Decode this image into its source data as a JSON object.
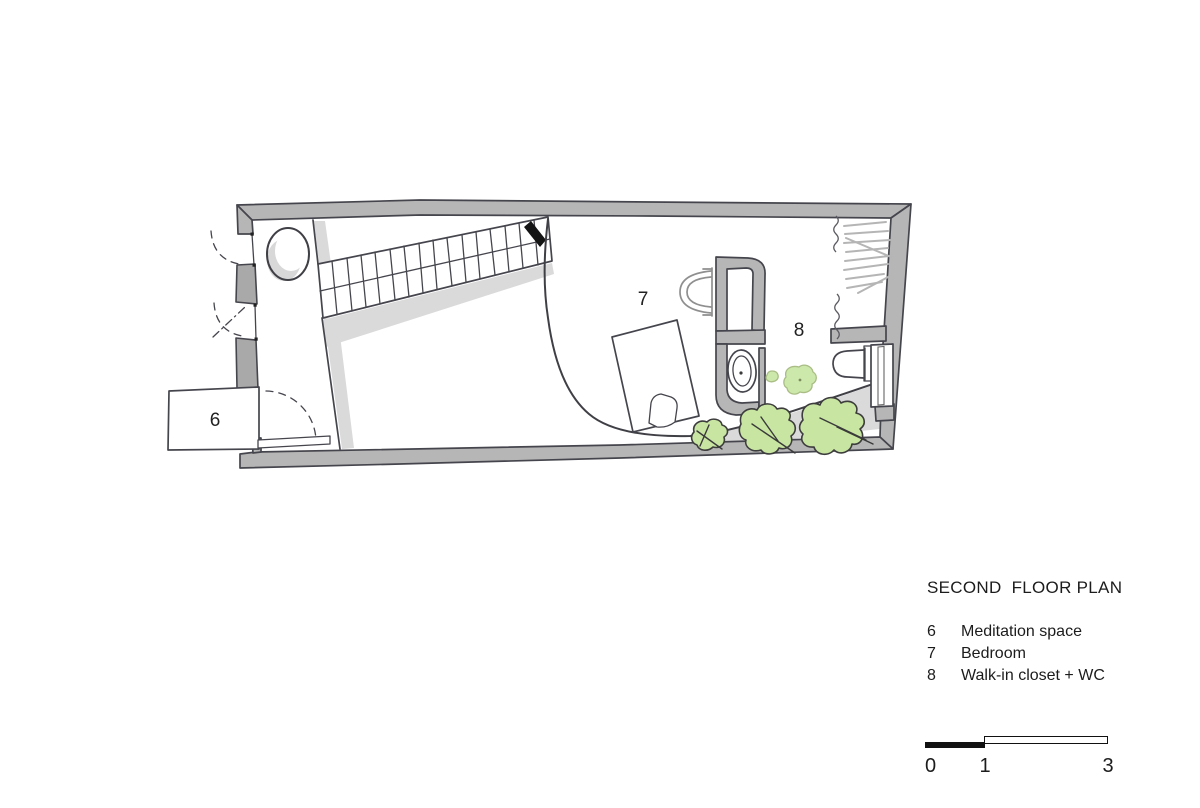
{
  "plan": {
    "room_labels": [
      {
        "number": "6"
      },
      {
        "number": "7"
      },
      {
        "number": "8"
      }
    ]
  },
  "legend": {
    "title": "SECOND  FLOOR PLAN",
    "items": [
      {
        "number": "6",
        "label": "Meditation space"
      },
      {
        "number": "7",
        "label": "Bedroom"
      },
      {
        "number": "8",
        "label": "Walk-in closet + WC"
      }
    ]
  },
  "scale_bar": {
    "ticks": [
      "0",
      "1",
      "3"
    ]
  },
  "colors": {
    "paper": "#ffffff",
    "wall_gray": "#b6b6b6",
    "shadow_gray": "#dadada",
    "line_dark": "#45454d",
    "plant_green": "#c8e5a2",
    "text": "#1c1c1c"
  }
}
